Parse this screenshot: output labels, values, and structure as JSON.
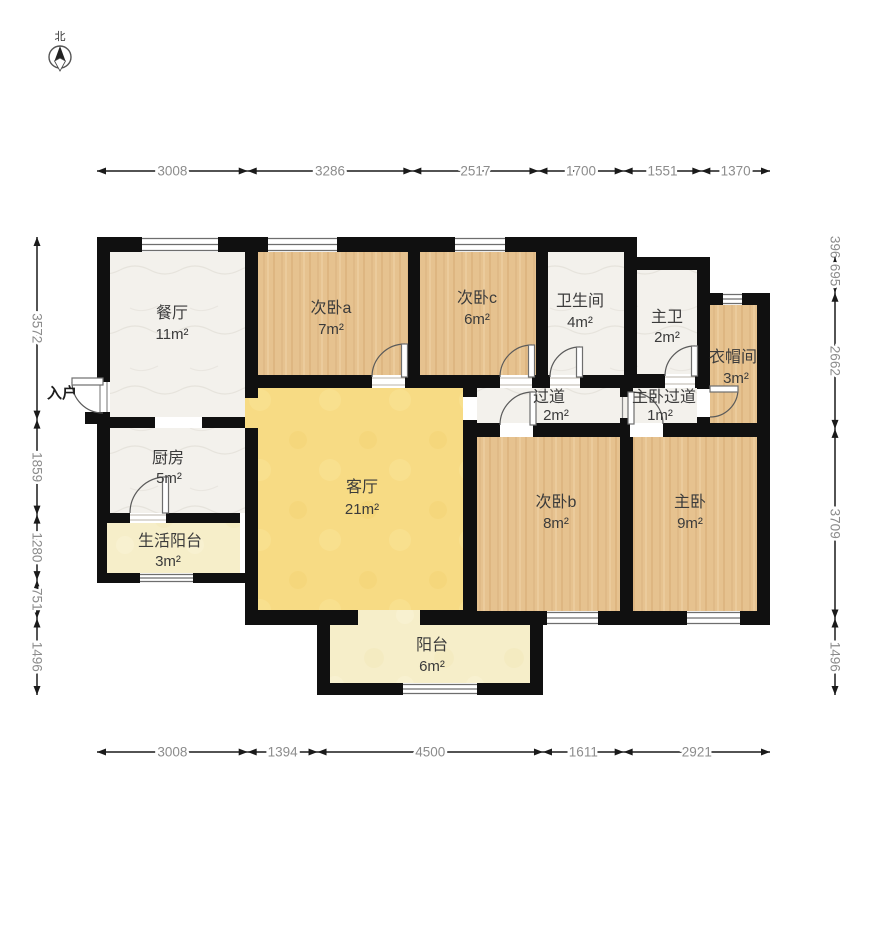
{
  "compass": {
    "north_label": "北"
  },
  "entrance": {
    "label": "入户"
  },
  "rooms": [
    {
      "id": "dining",
      "name": "餐厅",
      "area": "11m²"
    },
    {
      "id": "bedroom-a",
      "name": "次卧a",
      "area": "7m²"
    },
    {
      "id": "bedroom-c",
      "name": "次卧c",
      "area": "6m²"
    },
    {
      "id": "bathroom",
      "name": "卫生间",
      "area": "4m²"
    },
    {
      "id": "master-bath",
      "name": "主卫",
      "area": "2m²"
    },
    {
      "id": "closet",
      "name": "衣帽间",
      "area": "3m²"
    },
    {
      "id": "hallway",
      "name": "过道",
      "area": "2m²"
    },
    {
      "id": "master-hallway",
      "name": "主卧过道",
      "area": "1m²"
    },
    {
      "id": "kitchen",
      "name": "厨房",
      "area": "5m²"
    },
    {
      "id": "service-balcony",
      "name": "生活阳台",
      "area": "3m²"
    },
    {
      "id": "living-room",
      "name": "客厅",
      "area": "21m²"
    },
    {
      "id": "bedroom-b",
      "name": "次卧b",
      "area": "8m²"
    },
    {
      "id": "master-bedroom",
      "name": "主卧",
      "area": "9m²"
    },
    {
      "id": "balcony",
      "name": "阳台",
      "area": "6m²"
    }
  ],
  "dimensions": {
    "top": {
      "values": [
        3008,
        3286,
        2517,
        1700,
        1551,
        1370
      ]
    },
    "bottom": {
      "values": [
        3008,
        1394,
        4500,
        1611,
        2921
      ]
    },
    "left": {
      "values": [
        3572,
        1859,
        1280,
        751,
        1496
      ]
    },
    "right": {
      "values": [
        396,
        695,
        2662,
        3709,
        1496
      ]
    }
  },
  "colors": {
    "wall": "#101010",
    "wood_floor": "#e6c28f",
    "tile_floor": "#f3f1ec",
    "living_floor": "#f7db84",
    "balcony_floor": "#f6eec9",
    "dim_text": "#8c8c8c"
  }
}
